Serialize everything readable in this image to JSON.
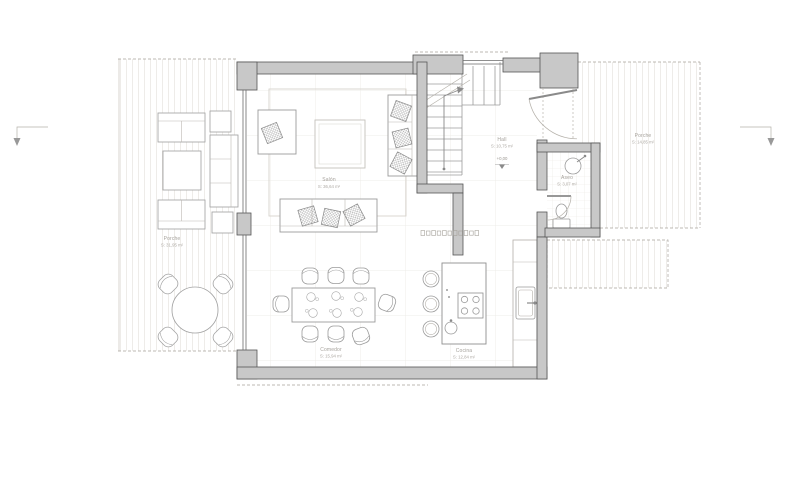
{
  "rooms": {
    "salon": {
      "name": "Salón",
      "area": "S: 36,64 m²"
    },
    "hall": {
      "name": "Hall",
      "area": "S: 10,75 m²",
      "level": "+0,00"
    },
    "aseo": {
      "name": "Aseo",
      "area": "S: 3,07 m²"
    },
    "comedor": {
      "name": "Comedor",
      "area": "S: 15,94 m²"
    },
    "cocina": {
      "name": "Cocina",
      "area": "S: 12,84 m²"
    },
    "porche_left": {
      "name": "Porche",
      "area": "S: 31,95 m²"
    },
    "porche_right": {
      "name": "Porche",
      "area": "S: 14,85 m²"
    }
  },
  "colors": {
    "wall_fill": "#c8c8c8",
    "wall_stroke": "#555555",
    "furniture_line": "#9b9b9b",
    "deck_line": "#d9d5ce",
    "grid_line": "#eeece8",
    "label_text": "#a5a19b",
    "dashed_line": "#a6a29b"
  }
}
